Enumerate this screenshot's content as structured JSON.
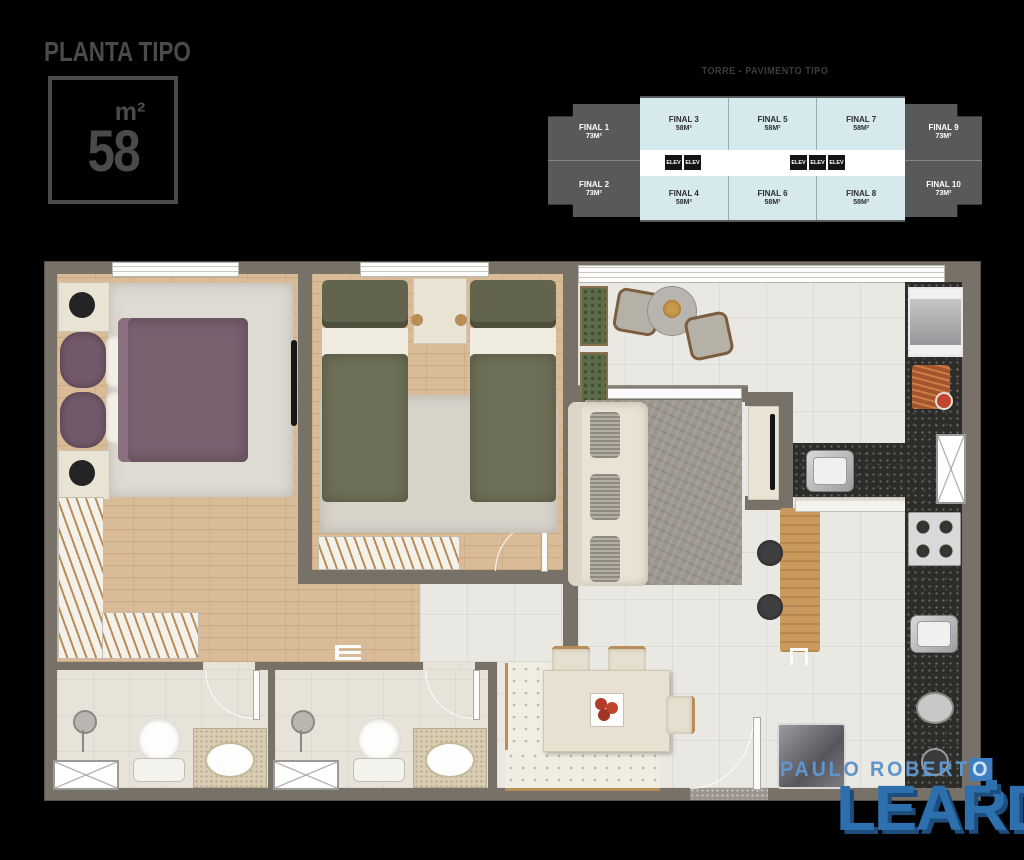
{
  "header": {
    "title": "PLANTA TIPO",
    "unit_label": "m²",
    "area_value": "58"
  },
  "keyplan": {
    "title": "TORRE - PAVIMENTO TIPO",
    "elev_label": "ELEV",
    "units": [
      {
        "name": "FINAL 1",
        "area": "73M²"
      },
      {
        "name": "FINAL 2",
        "area": "73M²"
      },
      {
        "name": "FINAL 3",
        "area": "58M²"
      },
      {
        "name": "FINAL 4",
        "area": "58M²"
      },
      {
        "name": "FINAL 5",
        "area": "58M²"
      },
      {
        "name": "FINAL 6",
        "area": "58M²"
      },
      {
        "name": "FINAL 7",
        "area": "58M²"
      },
      {
        "name": "FINAL 8",
        "area": "58M²"
      },
      {
        "name": "FINAL 9",
        "area": "73M²"
      },
      {
        "name": "FINAL 10",
        "area": "73M²"
      }
    ],
    "colors": {
      "dark_unit": "#58595b",
      "highlight_unit": "#d6e9ec",
      "corridor": "#ffffff",
      "elev_bg": "#141414"
    }
  },
  "floorplan": {
    "colors": {
      "wall": "#777168",
      "wood_floor": "#d9bc97",
      "tile_floor": "#eae8e2",
      "granite": "#2d2c29",
      "master_bed": "#7b6271",
      "single_bed": "#6e6f58",
      "living_rug": "#9d988e",
      "bar_wood": "#c9995e"
    }
  },
  "logo": {
    "line1": "PAULO ROBERT",
    "line1_last": "O",
    "line2": "LEARDI",
    "color_primary": "#2e6fae",
    "color_secondary": "#5e95cc"
  }
}
